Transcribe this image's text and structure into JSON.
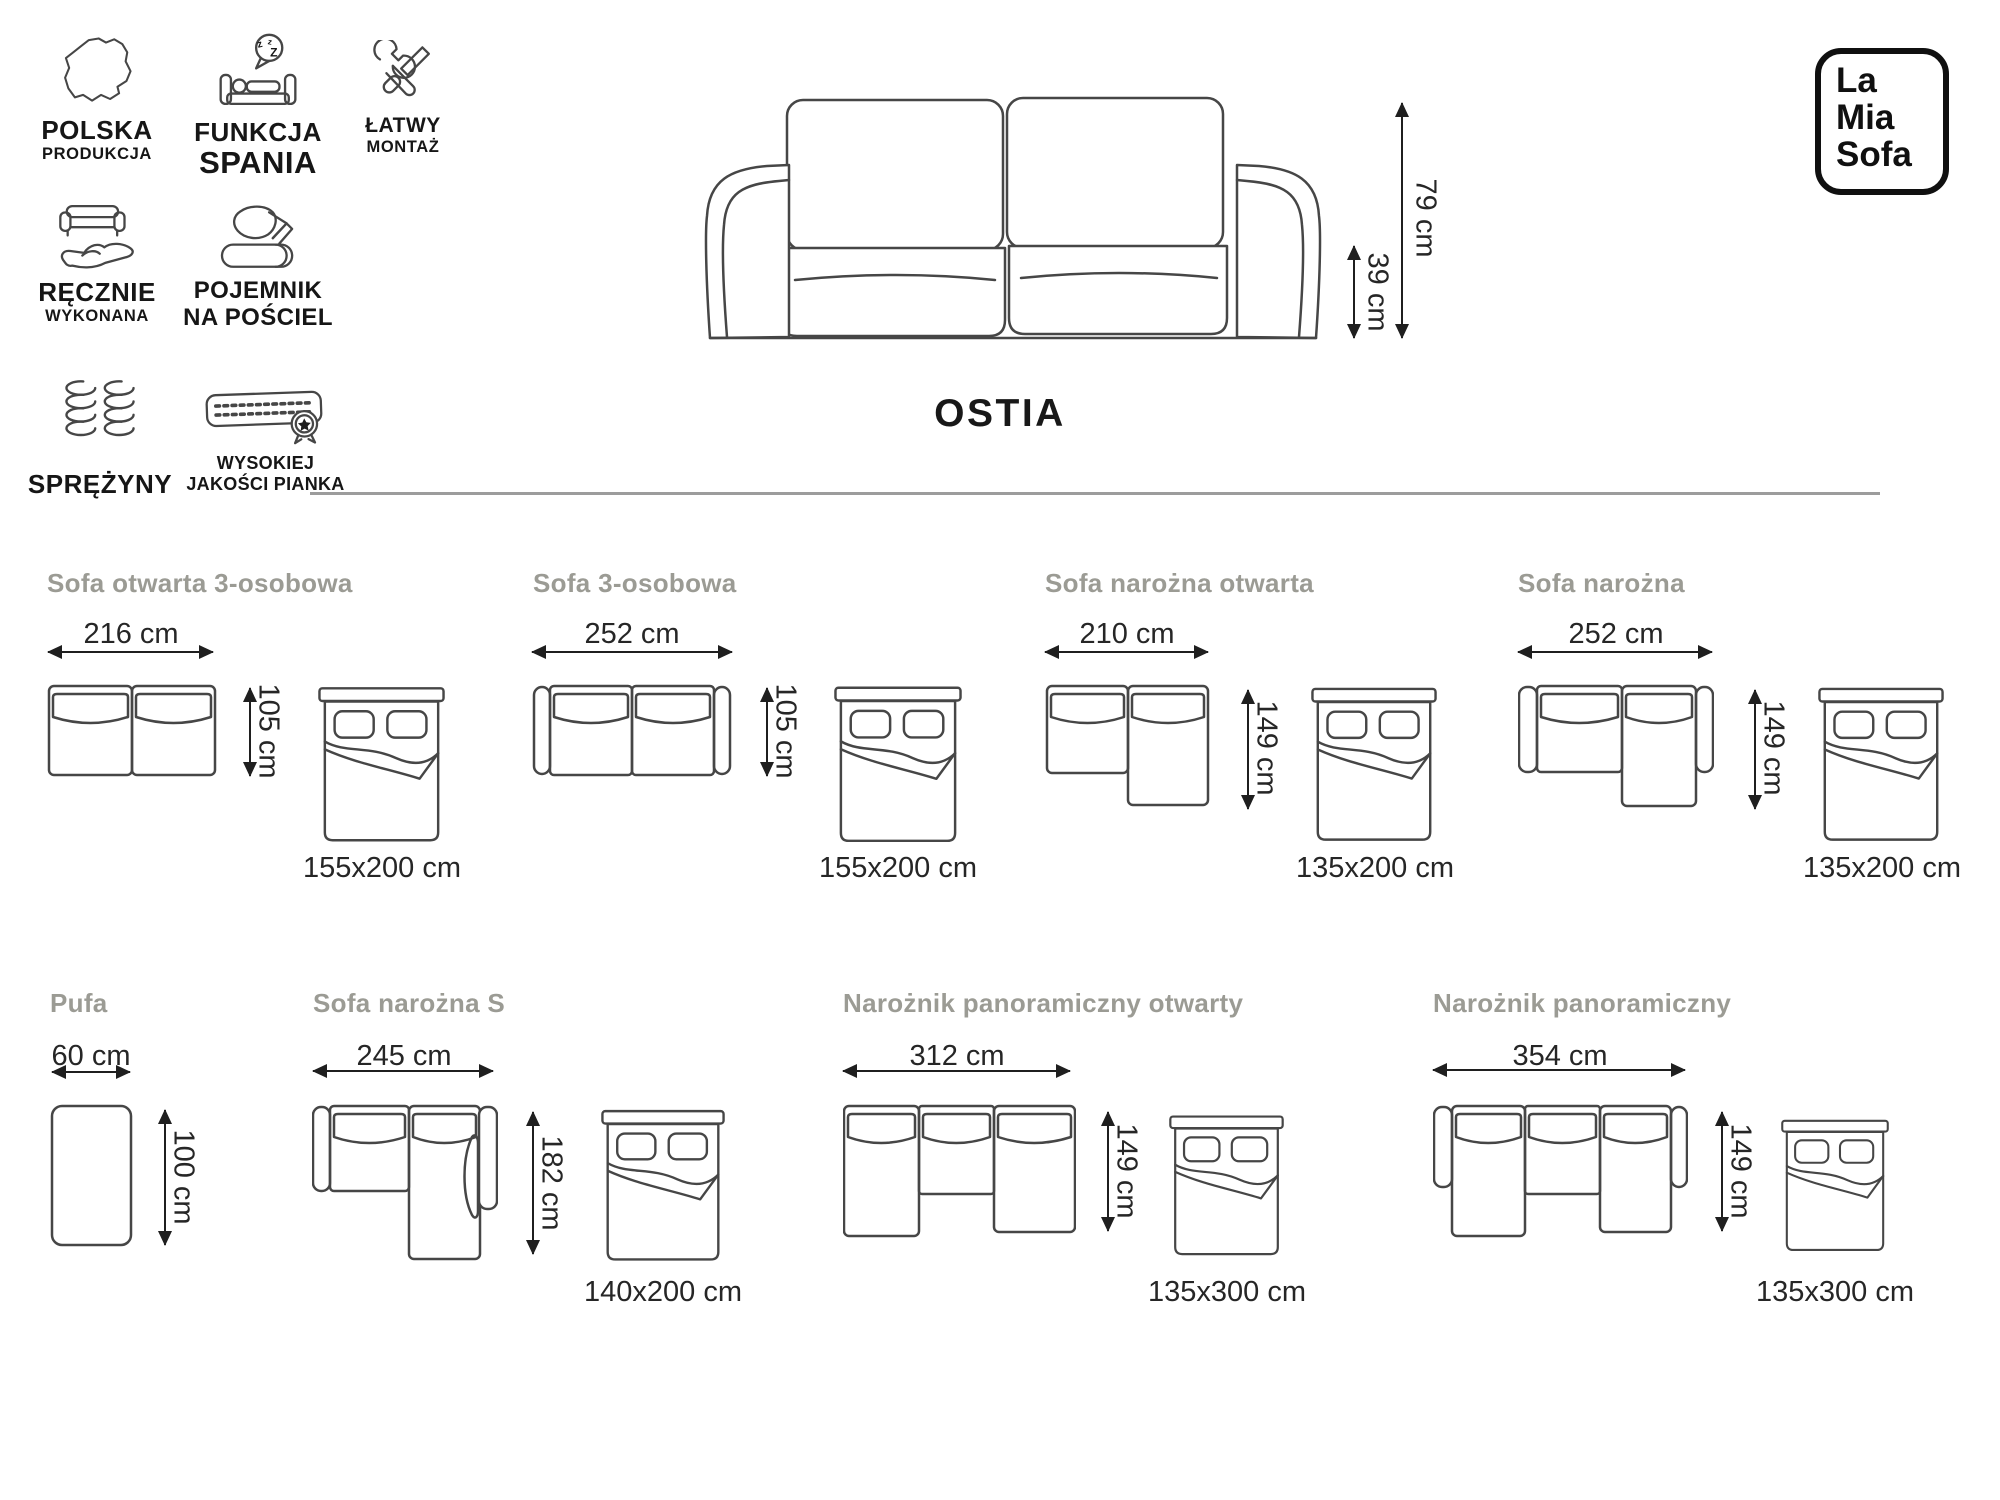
{
  "brand": {
    "line1": "La",
    "line2": "Mia",
    "line3": "Sofa"
  },
  "product": {
    "name": "OSTIA"
  },
  "features": [
    {
      "line1": "POLSKA",
      "line2": "PRODUKCJA",
      "icon": "poland-map"
    },
    {
      "line1": "FUNKCJA",
      "line2": "SPANIA",
      "icon": "sleep-function"
    },
    {
      "line1": "ŁATWY",
      "line2": "MONTAŻ",
      "icon": "easy-assembly-tools"
    },
    {
      "line1": "RĘCZNIE",
      "line2": "WYKONANA",
      "icon": "handmade"
    },
    {
      "line1": "POJEMNIK",
      "line2": "NA POŚCIEL",
      "icon": "bedding-storage"
    },
    {
      "line1": "SPRĘŻYNY",
      "line2": "",
      "icon": "springs"
    },
    {
      "line1": "WYSOKIEJ",
      "line2": "JAKOŚCI PIANKA",
      "icon": "high-quality-foam"
    }
  ],
  "main_dimensions": {
    "height": "79 cm",
    "seat_height": "39 cm"
  },
  "configurations": [
    {
      "title": "Sofa otwarta 3-osobowa",
      "width": "216 cm",
      "depth": "105 cm",
      "bed": "155x200 cm"
    },
    {
      "title": "Sofa 3-osobowa",
      "width": "252 cm",
      "depth": "105 cm",
      "bed": "155x200 cm"
    },
    {
      "title": "Sofa narożna otwarta",
      "width": "210 cm",
      "depth": "149 cm",
      "bed": "135x200 cm"
    },
    {
      "title": "Sofa narożna",
      "width": "252 cm",
      "depth": "149 cm",
      "bed": "135x200 cm"
    },
    {
      "title": "Pufa",
      "width": "60 cm",
      "depth": "100 cm"
    },
    {
      "title": "Sofa narożna S",
      "width": "245 cm",
      "depth": "182 cm",
      "bed": "140x200 cm"
    },
    {
      "title": "Narożnik panoramiczny otwarty",
      "width": "312 cm",
      "depth": "149 cm",
      "bed": "135x300 cm"
    },
    {
      "title": "Narożnik panoramiczny",
      "width": "354 cm",
      "depth": "149 cm",
      "bed": "135x300 cm"
    }
  ],
  "colors": {
    "line_art": "#464646",
    "text": "#1f1f1f",
    "muted_title": "#9b9b94",
    "separator": "#9c9c9c"
  }
}
